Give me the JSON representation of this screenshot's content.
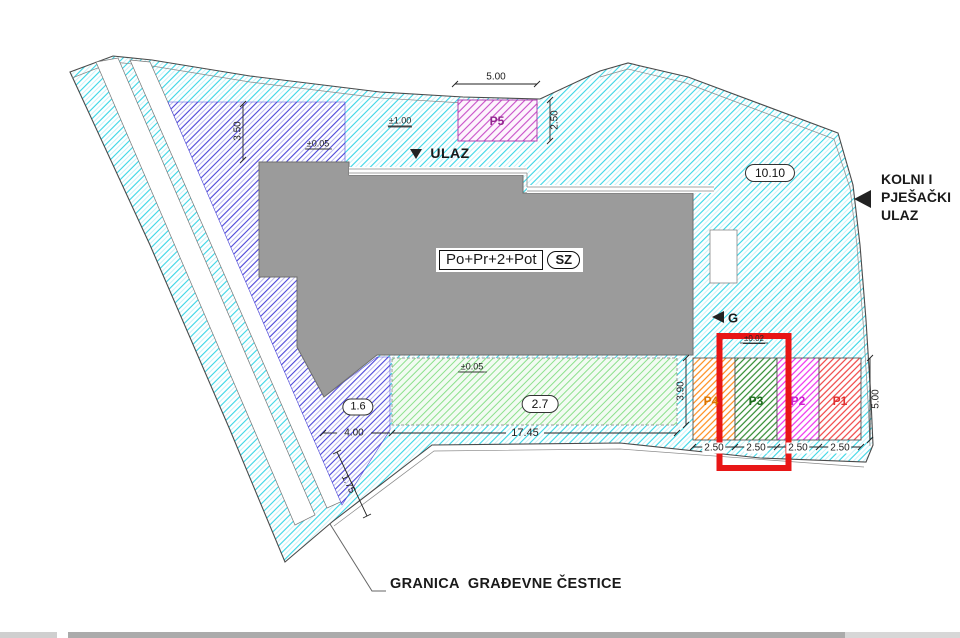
{
  "title_labels": {
    "building": "Po+Pr+2+Pot",
    "orientation": "SZ",
    "entrance": "ULAZ",
    "garage": "G",
    "access_line1": "KOLNI I",
    "access_line2": "PJEŠAČKI",
    "access_line3": "ULAZ",
    "boundary": "GRANICA  GRAĐEVNE ČESTICE"
  },
  "badges": {
    "area": "10.10",
    "left_zone": "1.6",
    "terrace": "2.7"
  },
  "elevations": {
    "north": "±1.00",
    "upper": "±0.05",
    "terrace": "±0.05",
    "parking": "±0.02"
  },
  "dimensions": {
    "p5_width": "5.00",
    "p5_depth": "2.50",
    "north_offset": "3.50",
    "terrace_length": "17.45",
    "terrace_depth": "3.90",
    "west_width": "4.00",
    "boundary_segment": "1.75",
    "parking_depth": "5.00"
  },
  "parking": {
    "guest_stall": "P5",
    "stalls": [
      {
        "label": "P4",
        "width": "2.50"
      },
      {
        "label": "P3",
        "width": "2.50"
      },
      {
        "label": "P2",
        "width": "2.50"
      },
      {
        "label": "P1",
        "width": "2.50"
      }
    ]
  },
  "colors": {
    "site_hatch": "#38d6e6",
    "site_hatch_light": "#a8ecf4",
    "zone_hatch": "#4a44d8",
    "zone_hatch_light": "#908ce8",
    "p5_hatch": "#c84fc8",
    "terrace_hatch": "#8ce08c",
    "terrace_bg": "#f2fbf2",
    "building_fill": "#9b9b9b",
    "building_stroke": "#6f6f6f",
    "stall_p4": "#ff8c1a",
    "stall_p3": "#2f8a2f",
    "stall_p2": "#ee30ee",
    "stall_p1": "#f04343",
    "highlight": "#e81616",
    "boundary": "#4a4a4a"
  }
}
